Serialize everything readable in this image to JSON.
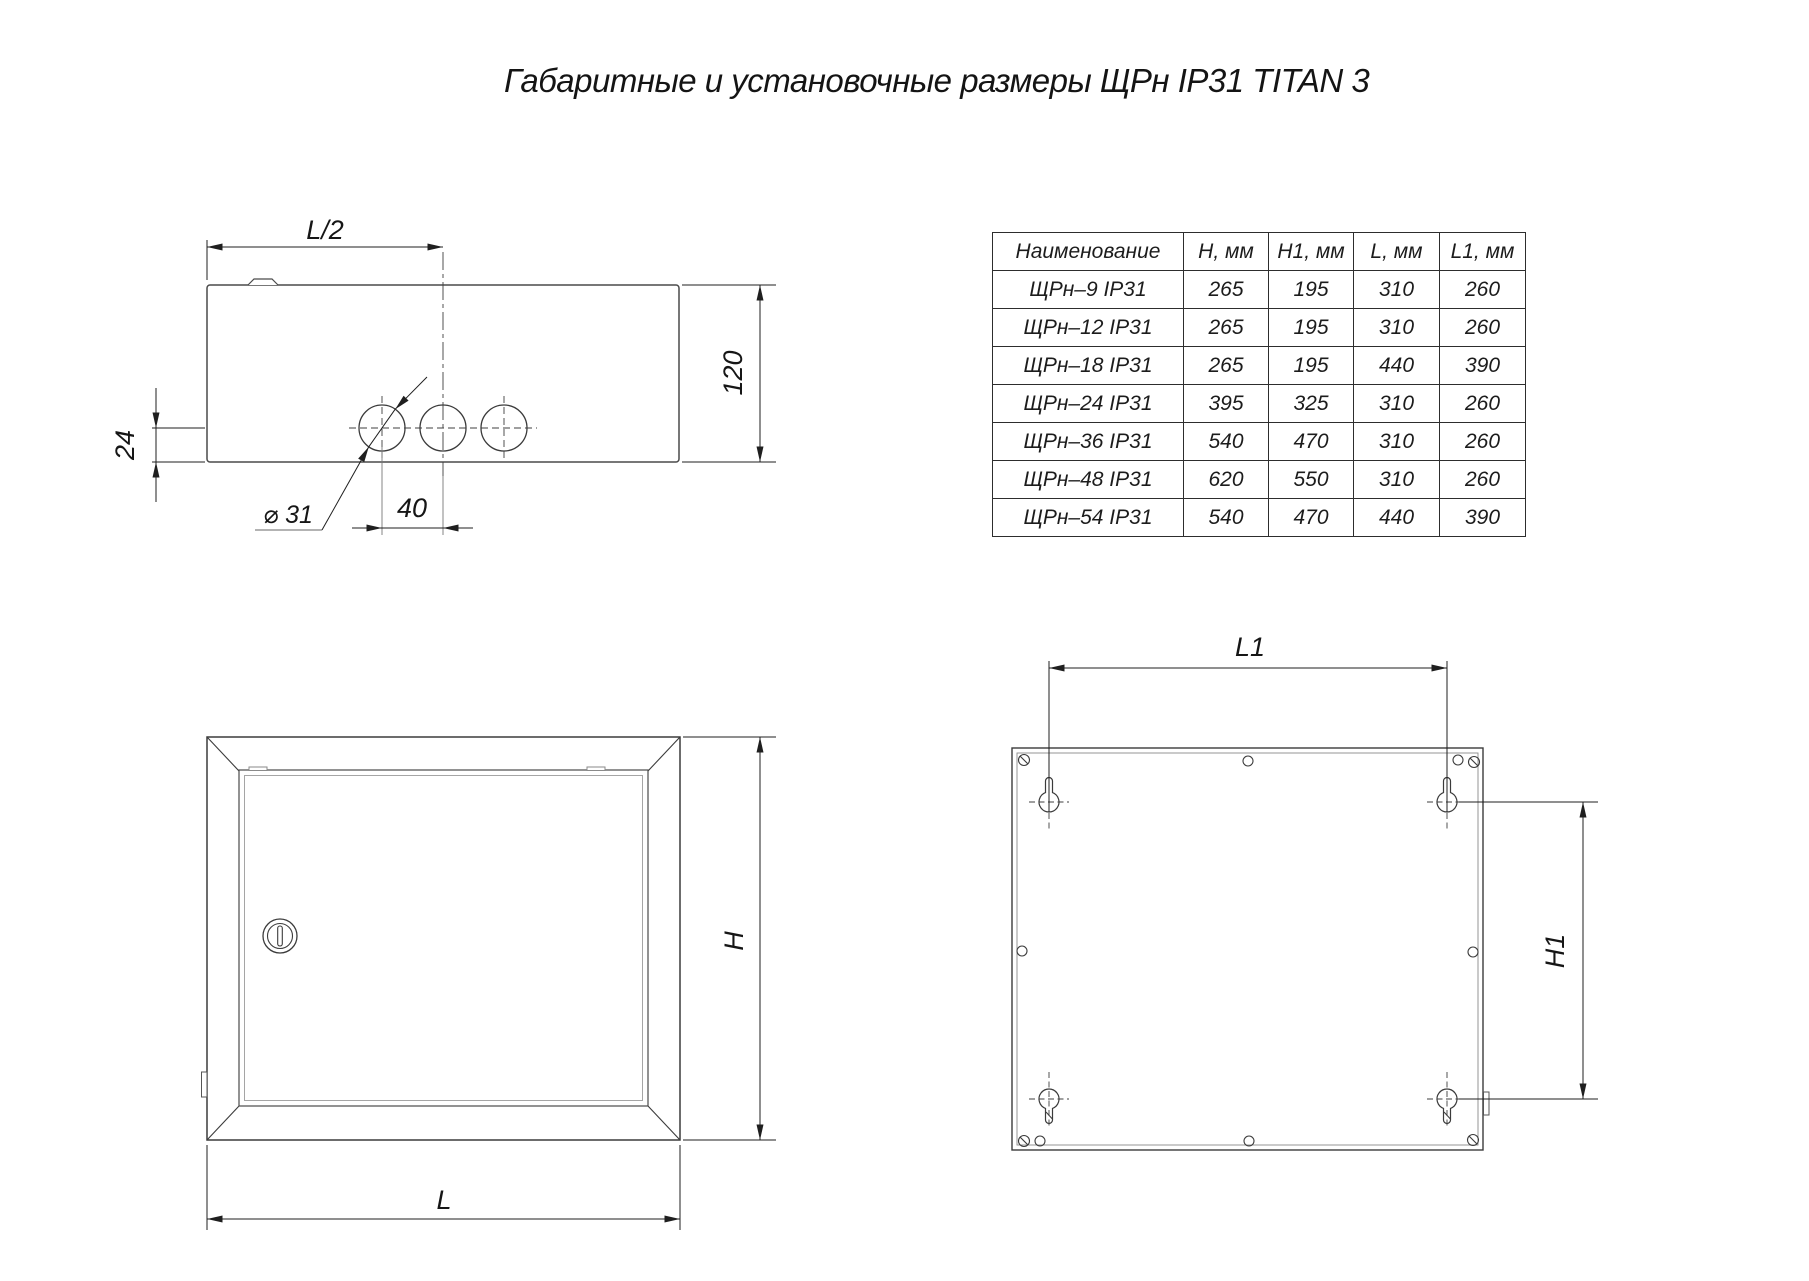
{
  "title": "Габаритные и установочные размеры ЩРн IP31 TITAN 3",
  "table": {
    "headers": [
      "Наименование",
      "H, мм",
      "H1, мм",
      "L, мм",
      "L1, мм"
    ],
    "rows": [
      [
        "ЩРн–9 IP31",
        "265",
        "195",
        "310",
        "260"
      ],
      [
        "ЩРн–12 IP31",
        "265",
        "195",
        "310",
        "260"
      ],
      [
        "ЩРн–18 IP31",
        "265",
        "195",
        "440",
        "390"
      ],
      [
        "ЩРн–24 IP31",
        "395",
        "325",
        "310",
        "260"
      ],
      [
        "ЩРн–36 IP31",
        "540",
        "470",
        "310",
        "260"
      ],
      [
        "ЩРн–48 IP31",
        "620",
        "550",
        "310",
        "260"
      ],
      [
        "ЩРн–54 IP31",
        "540",
        "470",
        "440",
        "390"
      ]
    ]
  },
  "dims": {
    "top": {
      "half_length": "L/2",
      "depth": "120",
      "hole_offset": "24",
      "hole_diameter": "⌀ 31",
      "hole_pitch": "40"
    },
    "front": {
      "height": "H",
      "length": "L"
    },
    "back": {
      "mount_length": "L1",
      "mount_height": "H1"
    }
  },
  "colors": {
    "line": "#3b3b3b",
    "dim_line": "#1f1f1f",
    "accent_grey": "#9a9a9a"
  }
}
